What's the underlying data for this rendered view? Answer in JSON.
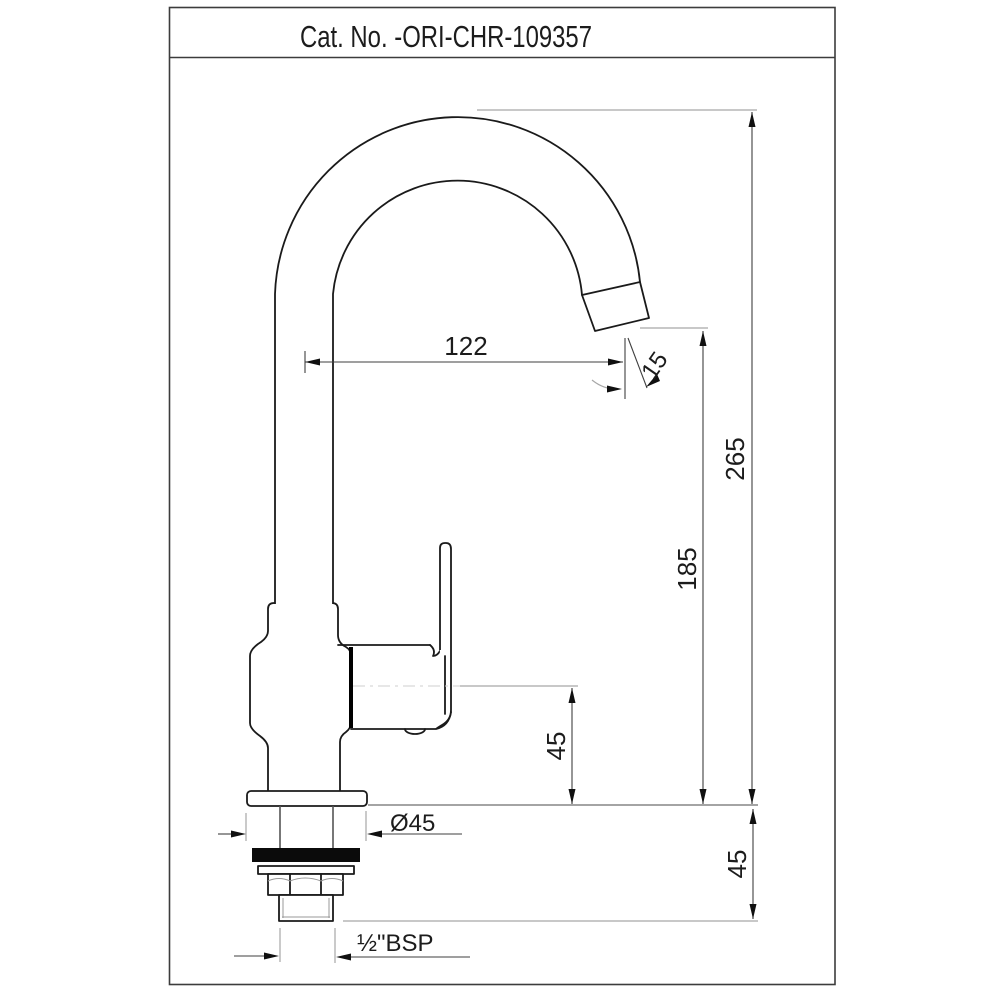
{
  "title": {
    "label": "Cat. No. -ORI-CHR-109357"
  },
  "drawing": {
    "type": "technical-drawing",
    "subject": "single-lever swan-neck pillar sink tap, side elevation",
    "units": "mm",
    "colors": {
      "ink": "#1a1a1a",
      "dimension": "#3f3f3f",
      "extension": "#a6a6a6",
      "paper": "#ffffff",
      "washer": "#0b0b0b"
    }
  },
  "dimensions": {
    "spout_reach": "122",
    "spout_end_angle": "15",
    "overall_height": "265",
    "spout_outlet_height": "185",
    "cartridge_center_height": "45",
    "shank_length": "45",
    "flange_diameter": "Ø45",
    "inlet_thread": "½\"BSP"
  }
}
